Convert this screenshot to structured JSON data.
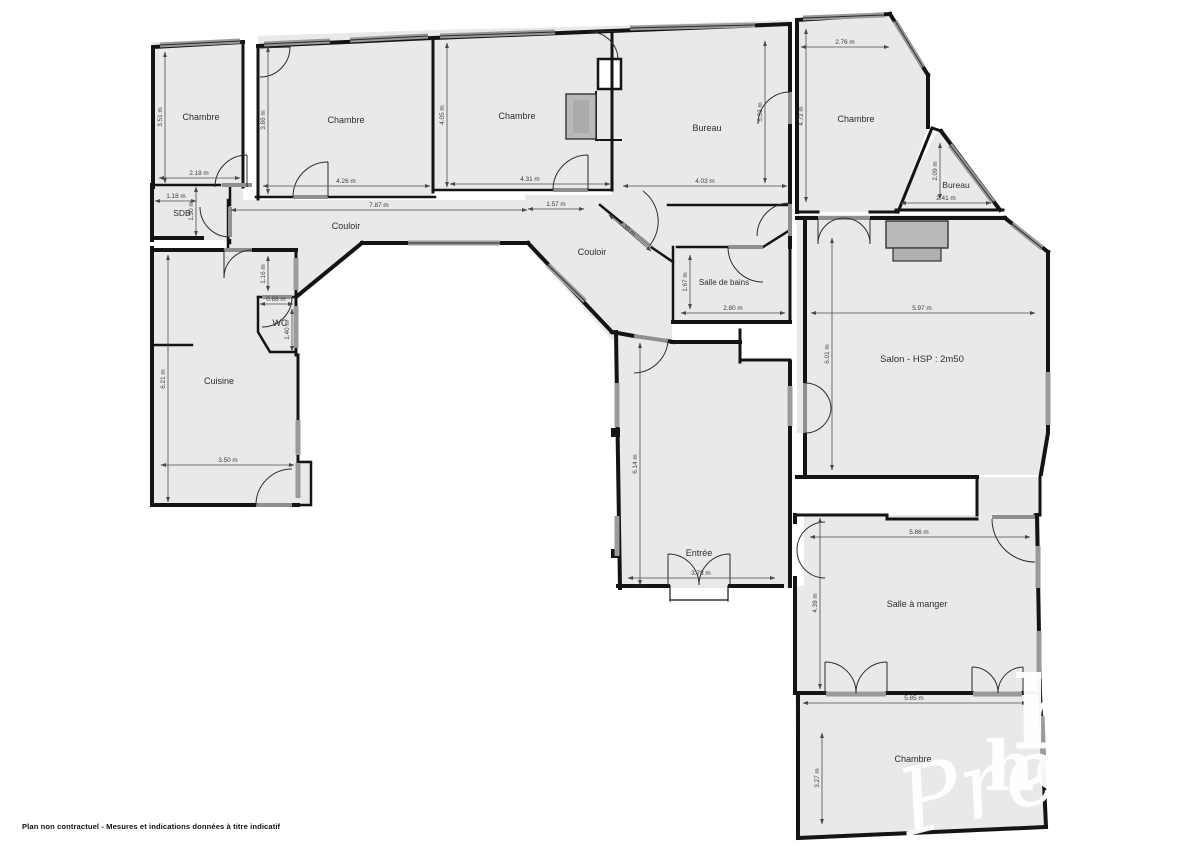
{
  "disclaimer": "Plan non contractuel - Mesures et indications données à titre indicatif",
  "watermark": {
    "word_serif_large": "hosman",
    "word_serif_small": "hosman",
    "word_script": "Prestige",
    "color": "#ffffff"
  },
  "colors": {
    "floor": "#e9e9e9",
    "wall": "#141414",
    "window": "#9a9a9a",
    "door_leaf": "#8f8f8f",
    "dim_line": "#4a4a4a",
    "fireplace": "#b9b9b9"
  },
  "rooms": [
    {
      "label": "Chambre",
      "x": 201,
      "y": 120,
      "fs": 9
    },
    {
      "label": "SDB",
      "x": 182,
      "y": 216,
      "fs": 8.5
    },
    {
      "label": "Chambre",
      "x": 346,
      "y": 123,
      "fs": 9
    },
    {
      "label": "Chambre",
      "x": 517,
      "y": 119,
      "fs": 9
    },
    {
      "label": "Bureau",
      "x": 707,
      "y": 131,
      "fs": 9
    },
    {
      "label": "Chambre",
      "x": 856,
      "y": 122,
      "fs": 9
    },
    {
      "label": "Bureau",
      "x": 956,
      "y": 188,
      "fs": 8.5
    },
    {
      "label": "Couloir",
      "x": 346,
      "y": 229,
      "fs": 9
    },
    {
      "label": "Couloir",
      "x": 592,
      "y": 255,
      "fs": 9
    },
    {
      "label": "Salle de bains",
      "x": 724,
      "y": 285,
      "fs": 8
    },
    {
      "label": "WC",
      "x": 280,
      "y": 326,
      "fs": 9
    },
    {
      "label": "Cuisine",
      "x": 219,
      "y": 384,
      "fs": 9
    },
    {
      "label": "Salon - HSP : 2m50",
      "x": 922,
      "y": 362,
      "fs": 9.5
    },
    {
      "label": "Entrée",
      "x": 699,
      "y": 556,
      "fs": 9
    },
    {
      "label": "Salle à manger",
      "x": 917,
      "y": 607,
      "fs": 9
    },
    {
      "label": "Chambre",
      "x": 913,
      "y": 762,
      "fs": 9
    }
  ],
  "dimensions": [
    {
      "value": "3.51 m",
      "x1": 165,
      "y1": 52,
      "x2": 165,
      "y2": 183,
      "tx": 162,
      "ty": 117,
      "rot": -90
    },
    {
      "value": "2.18 m",
      "x1": 159,
      "y1": 178,
      "x2": 240,
      "y2": 178,
      "tx": 199,
      "ty": 175,
      "rot": 0
    },
    {
      "value": "1.18 m",
      "x1": 155,
      "y1": 201,
      "x2": 196,
      "y2": 201,
      "tx": 176,
      "ty": 198,
      "rot": 0
    },
    {
      "value": "1.30 m",
      "x1": 196,
      "y1": 187,
      "x2": 196,
      "y2": 236,
      "tx": 193,
      "ty": 211,
      "rot": -90
    },
    {
      "value": "3.86 m",
      "x1": 268,
      "y1": 47,
      "x2": 268,
      "y2": 194,
      "tx": 265,
      "ty": 120,
      "rot": -90
    },
    {
      "value": "4.26 m",
      "x1": 263,
      "y1": 186,
      "x2": 430,
      "y2": 186,
      "tx": 346,
      "ty": 183,
      "rot": 0
    },
    {
      "value": "7.87 m",
      "x1": 231,
      "y1": 210,
      "x2": 527,
      "y2": 210,
      "tx": 379,
      "ty": 207,
      "rot": 0
    },
    {
      "value": "4.05 m",
      "x1": 447,
      "y1": 43,
      "x2": 447,
      "y2": 187,
      "tx": 444,
      "ty": 115,
      "rot": -90
    },
    {
      "value": "4.31 m",
      "x1": 450,
      "y1": 184,
      "x2": 610,
      "y2": 184,
      "tx": 530,
      "ty": 181,
      "rot": 0
    },
    {
      "value": "5.33 m",
      "x1": 765,
      "y1": 41,
      "x2": 765,
      "y2": 183,
      "tx": 762,
      "ty": 112,
      "rot": -90
    },
    {
      "value": "4.03 m",
      "x1": 623,
      "y1": 186,
      "x2": 787,
      "y2": 186,
      "tx": 705,
      "ty": 183,
      "rot": 0
    },
    {
      "value": "2.76 m",
      "x1": 801,
      "y1": 47,
      "x2": 889,
      "y2": 47,
      "tx": 845,
      "ty": 44,
      "rot": 0
    },
    {
      "value": "4.72 m",
      "x1": 806,
      "y1": 29,
      "x2": 806,
      "y2": 202,
      "tx": 803,
      "ty": 116,
      "rot": -90
    },
    {
      "value": "2.09 m",
      "x1": 940,
      "y1": 143,
      "x2": 940,
      "y2": 199,
      "tx": 937,
      "ty": 171,
      "rot": -90
    },
    {
      "value": "2.41 m",
      "x1": 901,
      "y1": 203,
      "x2": 991,
      "y2": 203,
      "tx": 946,
      "ty": 200,
      "rot": 0
    },
    {
      "value": "1.57 m",
      "x1": 528,
      "y1": 209,
      "x2": 584,
      "y2": 209,
      "tx": 556,
      "ty": 206,
      "rot": 0
    },
    {
      "value": "2.30 m",
      "x1": 609,
      "y1": 215,
      "x2": 651,
      "y2": 251,
      "tx": 626,
      "ty": 230,
      "rot": 41
    },
    {
      "value": "1.67 m",
      "x1": 690,
      "y1": 255,
      "x2": 690,
      "y2": 309,
      "tx": 687,
      "ty": 282,
      "rot": -90
    },
    {
      "value": "2.80 m",
      "x1": 681,
      "y1": 313,
      "x2": 785,
      "y2": 313,
      "tx": 733,
      "ty": 310,
      "rot": 0
    },
    {
      "value": "1.16 m",
      "x1": 268,
      "y1": 256,
      "x2": 268,
      "y2": 291,
      "tx": 265,
      "ty": 274,
      "rot": -90
    },
    {
      "value": "0.88 m",
      "x1": 260,
      "y1": 304,
      "x2": 293,
      "y2": 304,
      "tx": 276,
      "ty": 301,
      "rot": 0
    },
    {
      "value": "1.40 m",
      "x1": 292,
      "y1": 309,
      "x2": 292,
      "y2": 351,
      "tx": 289,
      "ty": 330,
      "rot": -90
    },
    {
      "value": "6.21 m",
      "x1": 168,
      "y1": 255,
      "x2": 168,
      "y2": 502,
      "tx": 165,
      "ty": 379,
      "rot": -90
    },
    {
      "value": "3.50 m",
      "x1": 161,
      "y1": 465,
      "x2": 294,
      "y2": 465,
      "tx": 228,
      "ty": 462,
      "rot": 0
    },
    {
      "value": "5.97 m",
      "x1": 811,
      "y1": 313,
      "x2": 1035,
      "y2": 313,
      "tx": 922,
      "ty": 310,
      "rot": 0
    },
    {
      "value": "6.01 m",
      "x1": 832,
      "y1": 238,
      "x2": 832,
      "y2": 470,
      "tx": 829,
      "ty": 354,
      "rot": -90
    },
    {
      "value": "6.14 m",
      "x1": 640,
      "y1": 343,
      "x2": 640,
      "y2": 585,
      "tx": 637,
      "ty": 464,
      "rot": -90
    },
    {
      "value": "3.78 m",
      "x1": 628,
      "y1": 578,
      "x2": 775,
      "y2": 578,
      "tx": 701,
      "ty": 575,
      "rot": 0
    },
    {
      "value": "5.86 m",
      "x1": 810,
      "y1": 537,
      "x2": 1030,
      "y2": 537,
      "tx": 919,
      "ty": 534,
      "rot": 0
    },
    {
      "value": "4.39 m",
      "x1": 820,
      "y1": 518,
      "x2": 820,
      "y2": 689,
      "tx": 817,
      "ty": 603,
      "rot": -90
    },
    {
      "value": "5.85 m",
      "x1": 803,
      "y1": 703,
      "x2": 1027,
      "y2": 703,
      "tx": 914,
      "ty": 700,
      "rot": 0
    },
    {
      "value": "3.27 m",
      "x1": 822,
      "y1": 733,
      "x2": 822,
      "y2": 824,
      "tx": 819,
      "ty": 778,
      "rot": -90
    }
  ]
}
